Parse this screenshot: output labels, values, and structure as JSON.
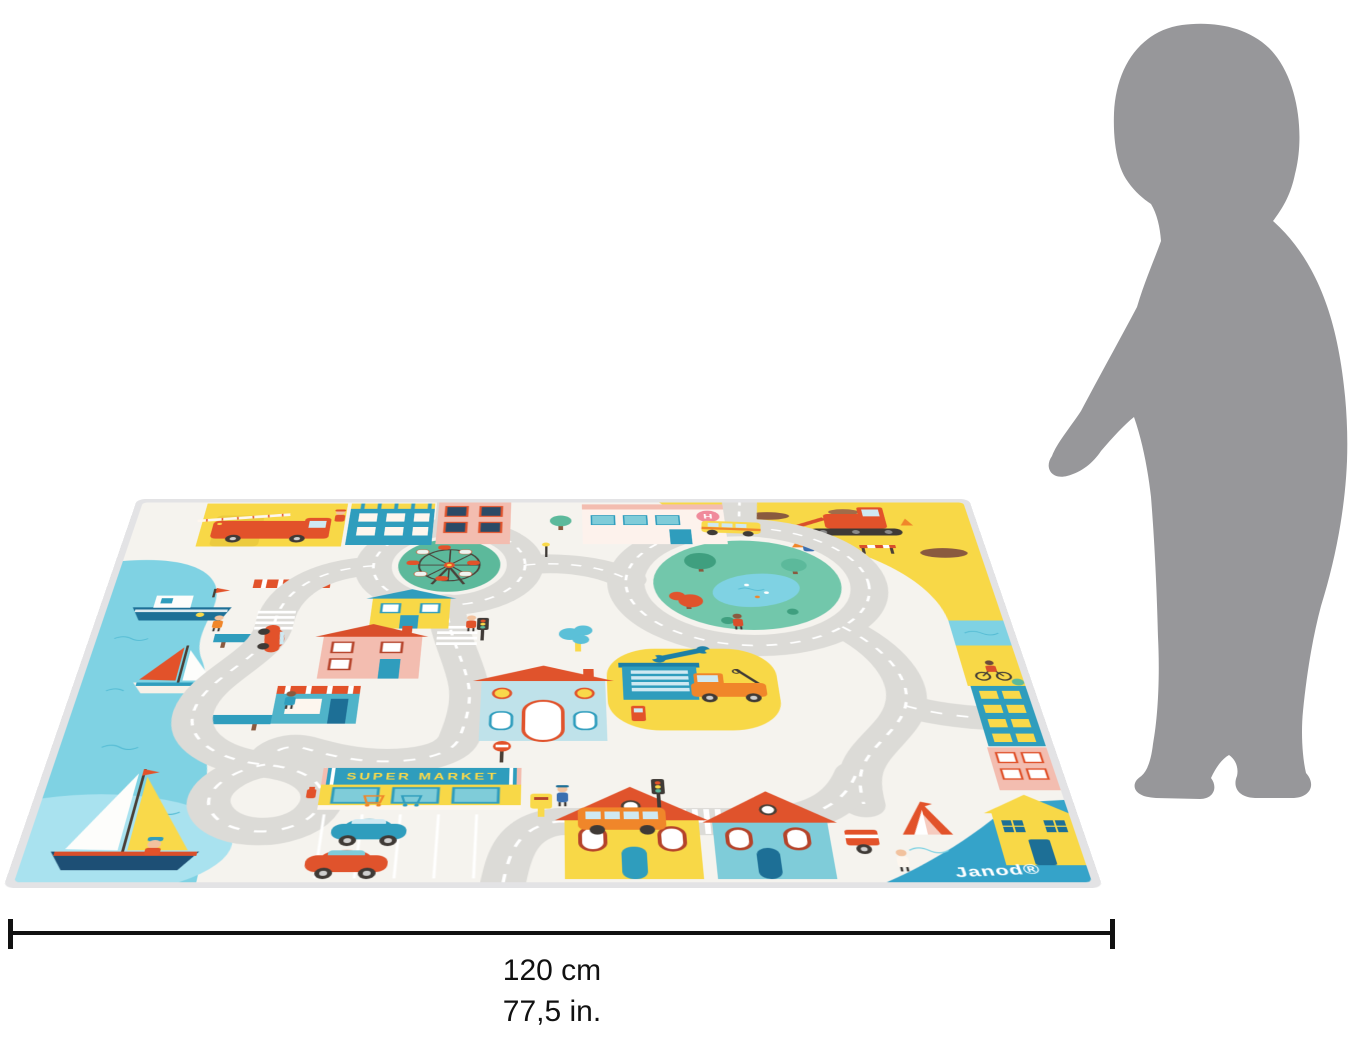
{
  "product": {
    "type": "city-road-play-mat",
    "brand_mark": "Janod®",
    "supermarket_sign": "SUPER MARKET",
    "hospital_sign": "H"
  },
  "size_annotation": {
    "width_metric": "120 cm",
    "width_imperial": "77,5 in."
  },
  "scale_figure": "child-silhouette",
  "scene_regions": [
    "harbor",
    "fire-station",
    "hospital",
    "roundabout-ferris-wheel",
    "construction-zone",
    "park",
    "school",
    "garage",
    "supermarket",
    "parking-lot",
    "row-houses",
    "blue-harbor-corner"
  ],
  "colors": {
    "mat_base": "#f5f3ee",
    "road_gray": "#dcdbd7",
    "water_blue": "#7fd2e3",
    "construction_yellow": "#f8d847",
    "accent_red": "#e2522a",
    "accent_teal": "#2f9dbd",
    "park_green": "#72c7ab",
    "roof_orange": "#e0532c",
    "silhouette_gray": "#97979a",
    "dimension_line": "#111111"
  }
}
